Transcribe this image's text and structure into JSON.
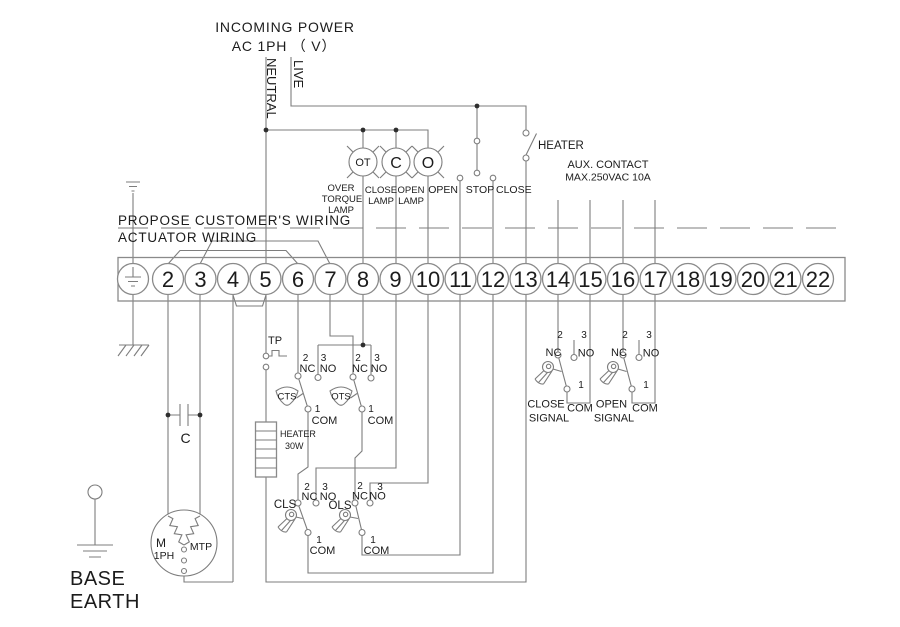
{
  "header": {
    "title": "INCOMING POWER",
    "subtitle": "AC  1PH （ V）",
    "neutral": "NEUTRAL",
    "live": "LIVE"
  },
  "controls": {
    "lamps": [
      {
        "symbol": "OT",
        "label": [
          "OVER",
          "TORQUE",
          "LAMP"
        ]
      },
      {
        "symbol": "C",
        "label": [
          "CLOSE",
          "LAMP"
        ]
      },
      {
        "symbol": "O",
        "label": [
          "OPEN",
          "LAMP"
        ]
      }
    ],
    "buttons": [
      "OPEN",
      "STOP",
      "CLOSE"
    ],
    "heater_switch_label": "HEATER",
    "aux_contact": [
      "AUX. CONTACT",
      "MAX.250VAC 10A"
    ]
  },
  "divider": {
    "customer": "PROPOSE CUSTOMER'S WIRING",
    "actuator": "ACTUATOR WIRING"
  },
  "terminal_strip": {
    "numbers": [
      "2",
      "3",
      "4",
      "5",
      "6",
      "7",
      "8",
      "9",
      "10",
      "11",
      "12",
      "13",
      "14",
      "15",
      "16",
      "17",
      "18",
      "19",
      "20",
      "21",
      "22"
    ]
  },
  "contact_labels": {
    "nc_num": "2",
    "no_num": "3",
    "com_num": "1",
    "nc": "NC",
    "no": "NO",
    "com": "COM"
  },
  "switches": {
    "tp": "TP",
    "cts": "CTS",
    "ots": "OTS",
    "cls": "CLS",
    "ols": "OLS",
    "close_signal": [
      "CLOSE",
      "SIGNAL"
    ],
    "open_signal": [
      "OPEN",
      "SIGNAL"
    ]
  },
  "components": {
    "heater": [
      "HEATER",
      "30W"
    ],
    "capacitor": "C",
    "motor": {
      "m": "M",
      "phase": "1PH",
      "mtp": "MTP"
    }
  },
  "base_earth": [
    "BASE",
    "EARTH"
  ],
  "colors": {
    "wire": "#7d7d7d",
    "text": "#1c1c1c",
    "background": "#ffffff"
  }
}
